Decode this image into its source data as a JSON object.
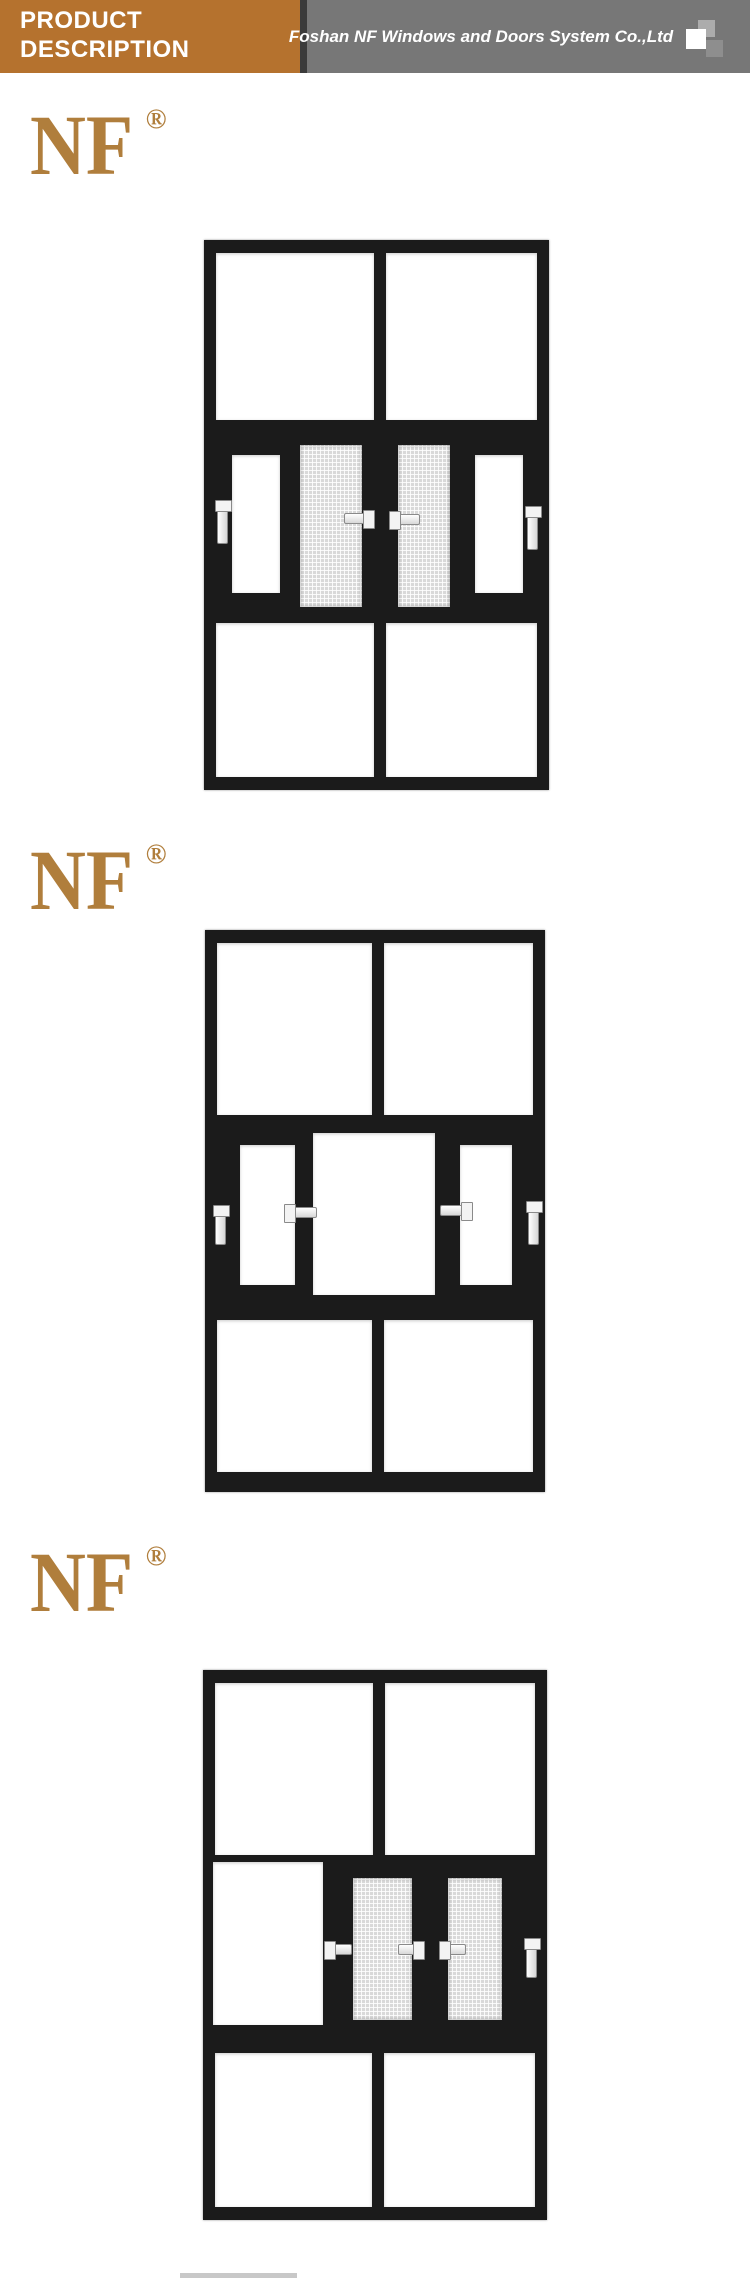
{
  "header": {
    "title_line1": "PRODUCT",
    "title_line2": "DESCRIPTION",
    "company": "Foshan NF Windows and Doors System Co.,Ltd"
  },
  "logo": {
    "text": "NF",
    "registered": "®"
  },
  "colors": {
    "accent-orange": "#B5722E",
    "header-gray": "#777777",
    "header-divider": "#3B3B3B",
    "logo-gold": "#B07E3C",
    "frame-black": "#1B1B1B",
    "mesh-gray": "#D9D9D9",
    "handle-white": "#FFFFFF"
  }
}
